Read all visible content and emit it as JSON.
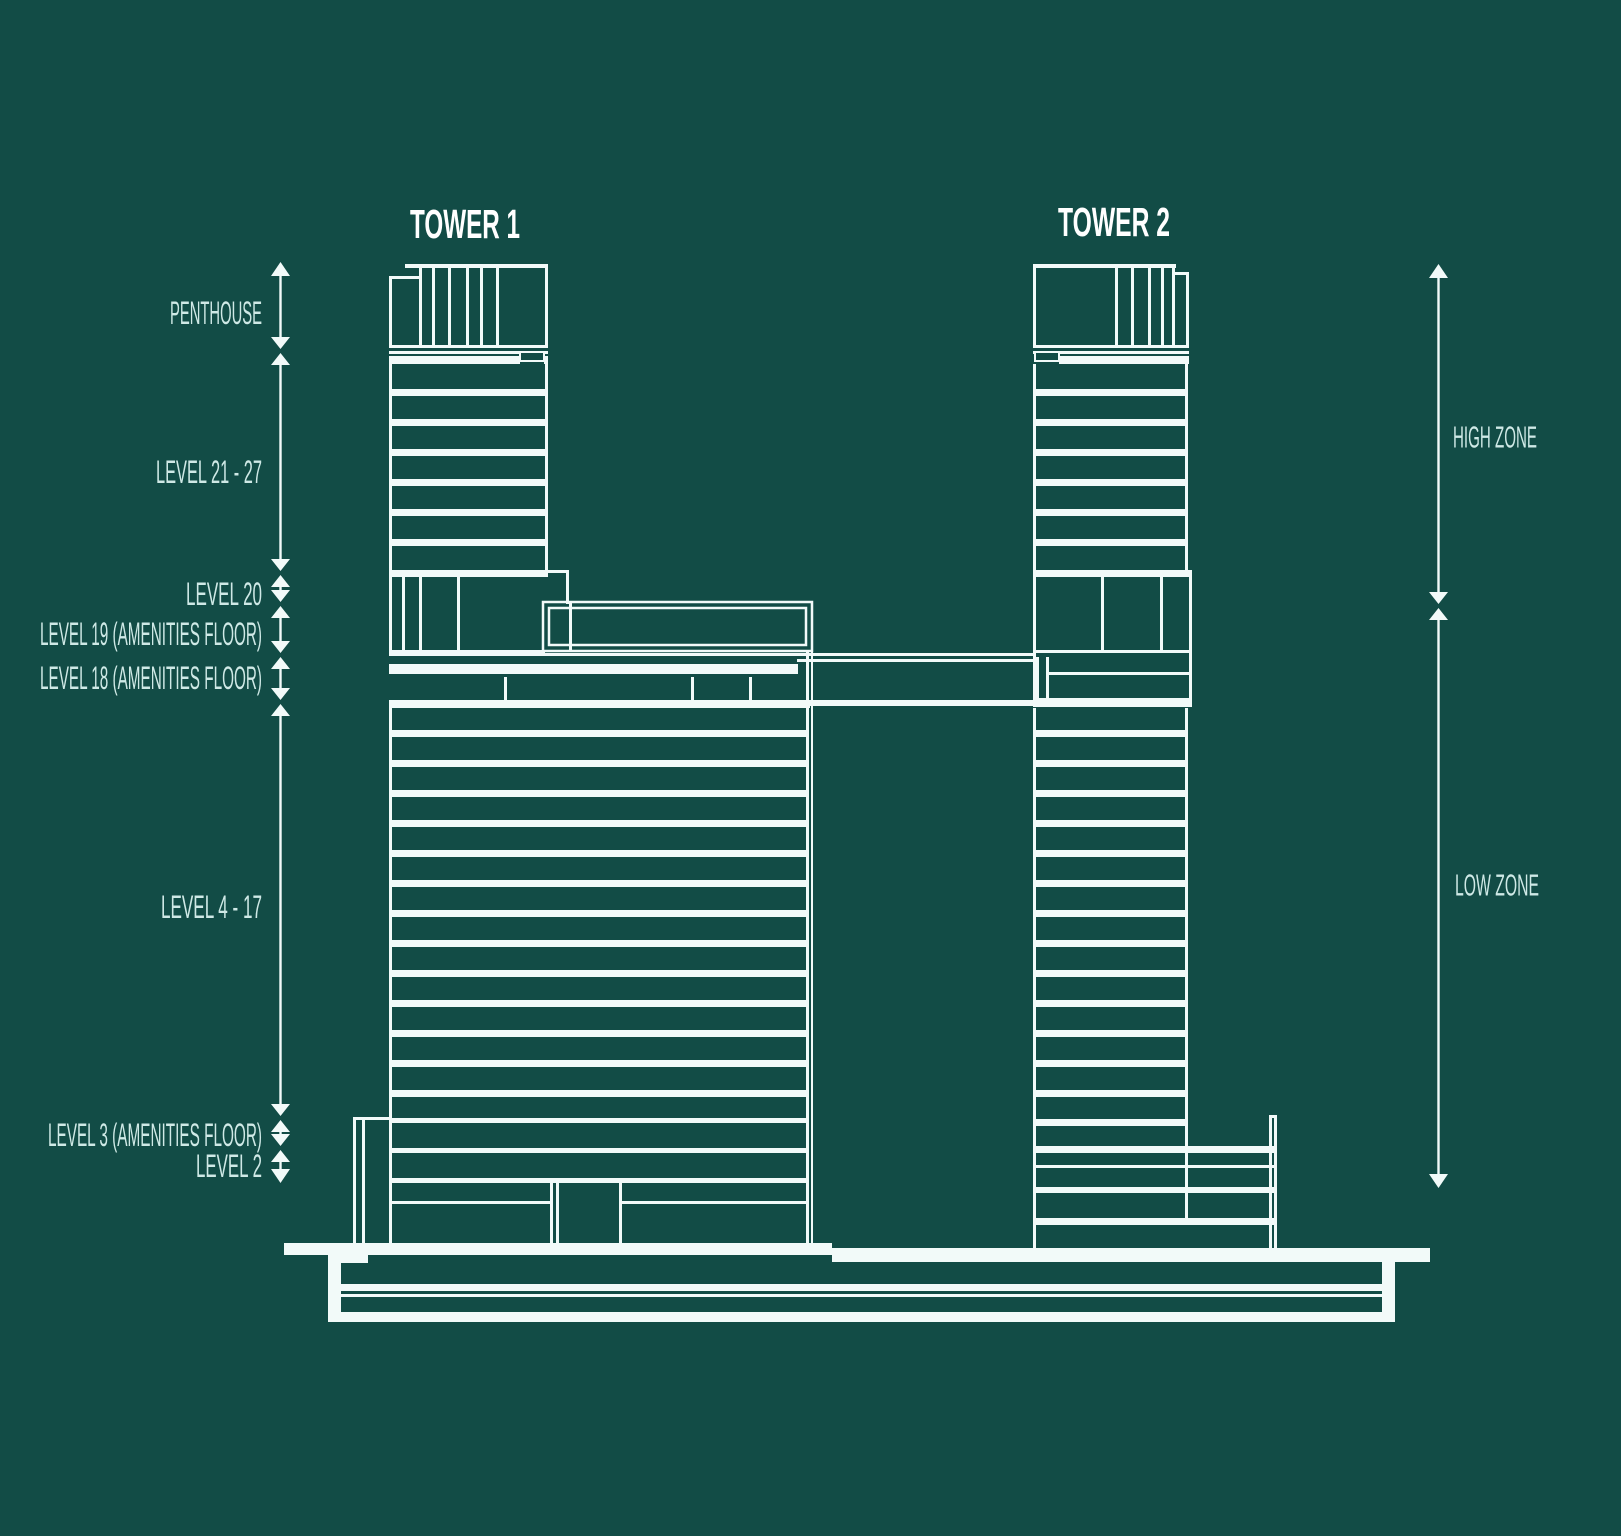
{
  "diagram": {
    "type": "building-section-elevation",
    "towers": [
      {
        "title": "TOWER 1"
      },
      {
        "title": "TOWER 2"
      }
    ],
    "left_levels": [
      {
        "label": "PENTHOUSE"
      },
      {
        "label": "LEVEL 21 - 27"
      },
      {
        "label": "LEVEL 20"
      },
      {
        "label": "LEVEL 19 (AMENITIES FLOOR)"
      },
      {
        "label": "LEVEL 18 (AMENITIES FLOOR)"
      },
      {
        "label": "LEVEL 4 - 17"
      },
      {
        "label": "LEVEL 3 (AMENITIES FLOOR)"
      },
      {
        "label": "LEVEL 2"
      }
    ],
    "right_zones": [
      {
        "label": "HIGH ZONE"
      },
      {
        "label": "LOW ZONE"
      }
    ],
    "colors": {
      "background": "#124c46",
      "line": "#f2faf9",
      "label_text": "#cfe9e6",
      "title_text": "#ffffff"
    }
  }
}
